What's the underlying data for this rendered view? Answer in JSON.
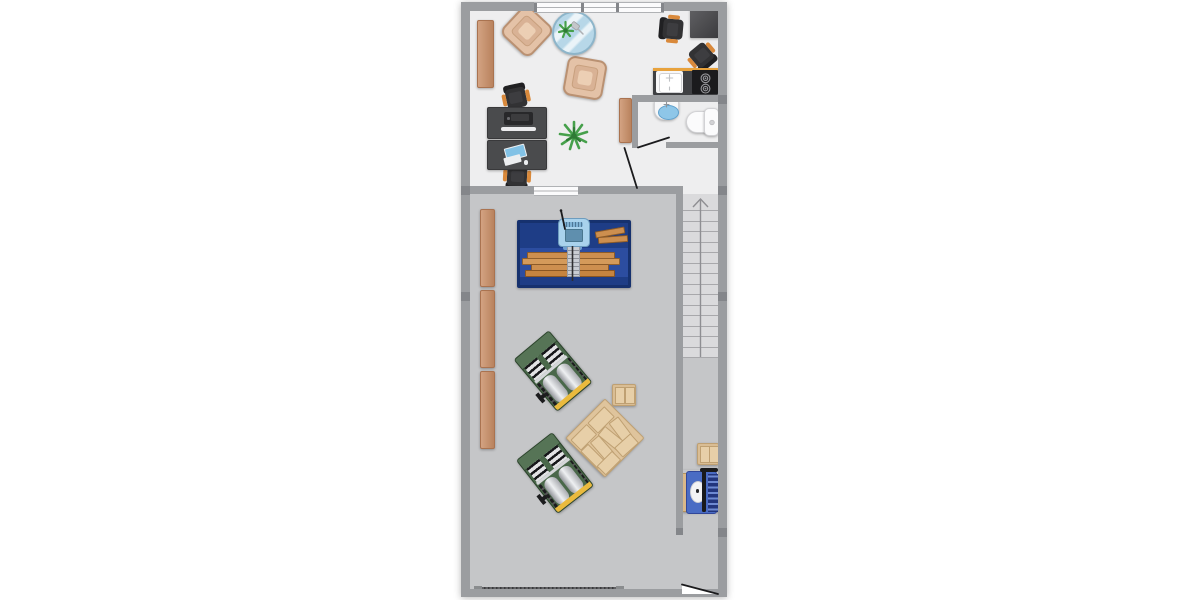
{
  "meta": {
    "view": "2d-floor-plan",
    "canvas": {
      "width": 1200,
      "height": 600
    }
  },
  "palette": {
    "page-bg": "#ffffff",
    "wall": "#9b9da0",
    "wall-joint": "#84868a",
    "office-floor": "#eeeeef",
    "workshop-floor": "#c5c6c8",
    "stair-floor": "#dadadc",
    "stair-line": "#a8a8ab",
    "window-fill": "#fbfbfc",
    "window-line": "#b0b2b5",
    "door-line": "#1b1b1d",
    "shelf": "#c98e66",
    "shelf-border": "#aa7350",
    "armchair": "#e4c2a7",
    "armchair-border": "#ba9172",
    "armchair-cushion": "#d9b295",
    "armchair-cushion-light": "#eccfb4",
    "glass": "#b7d7e8",
    "glass-border": "#8db5ca",
    "plant": "#46a04b",
    "plant-dark": "#2f7a35",
    "chair-body": "#323234",
    "chair-dark": "#202022",
    "chair-accent": "#d9893b",
    "desk": "#4a4b4d",
    "desk-border": "#39393b",
    "printer": "#28282a",
    "paper": "#ececee",
    "screen": "#82c2e6",
    "counter": "#3f4043",
    "counter-edge": "#e8a23c",
    "cooktop": "#1b1b1d",
    "fixture-white": "#f7f7f8",
    "fixture-border": "#d2d2d5",
    "basin-blue": "#8ec6e8",
    "bench": "#1e3d86",
    "bench-mid": "#2c4da0",
    "bench-border": "#16316e",
    "machine-head": "#a9d2ec",
    "machine-screen": "#5f8fae",
    "column": "#c9cdd3",
    "wood": "#cd8f4f",
    "green-machine": "#4a684a",
    "green-machine-light": "#567456",
    "green-machine-border": "#2b432b",
    "stripe-light": "#e2e2e4",
    "stripe-dark": "#17171a",
    "yellow": "#eaba3e",
    "pallet": "#dfc49c",
    "pallet-border": "#bfa072",
    "pallet-plank": "#e7cfa8",
    "crate": "#d9bd94",
    "blue-machine": "#4a6cc4",
    "blue-machine-dark": "#22357c",
    "blue-machine-slat": "#6e8ad2",
    "machine-base-wood": "#d9b98a",
    "garage-bar": "#59595c"
  },
  "plan": {
    "rooms": [
      {
        "id": "office-studio",
        "floor": "office-floor"
      },
      {
        "id": "kitchenette",
        "floor": "office-floor"
      },
      {
        "id": "bathroom",
        "floor": "office-floor"
      },
      {
        "id": "hallway",
        "floor": "office-floor"
      },
      {
        "id": "workshop",
        "floor": "workshop-floor"
      },
      {
        "id": "stairwell",
        "floor": "stair-floor"
      }
    ],
    "stairs": {
      "steps": 14,
      "direction": "up"
    },
    "openings": {
      "windows": 2,
      "doors": 3,
      "garage_doors": 1
    },
    "items": [
      {
        "name": "sideboard",
        "room": "office-studio",
        "count": 2
      },
      {
        "name": "armchair",
        "room": "office-studio",
        "count": 2
      },
      {
        "name": "round-glass-table",
        "room": "office-studio",
        "count": 1
      },
      {
        "name": "table-plant",
        "room": "office-studio",
        "count": 1
      },
      {
        "name": "floor-plant",
        "room": "office-studio",
        "count": 1
      },
      {
        "name": "office-chair",
        "room": "office-studio",
        "count": 4
      },
      {
        "name": "desk-with-printer",
        "room": "office-studio",
        "count": 1
      },
      {
        "name": "desk-with-computer",
        "room": "office-studio",
        "count": 1
      },
      {
        "name": "corner-table",
        "room": "office-studio",
        "count": 1
      },
      {
        "name": "kitchen-counter-sink-cooktop",
        "room": "kitchenette",
        "count": 1
      },
      {
        "name": "wash-basin",
        "room": "bathroom",
        "count": 1
      },
      {
        "name": "toilet",
        "room": "bathroom",
        "count": 1
      },
      {
        "name": "workbench-with-saw",
        "room": "workshop",
        "count": 1
      },
      {
        "name": "lumber-planks",
        "room": "workshop",
        "count": 6
      },
      {
        "name": "planer-machine",
        "room": "workshop",
        "count": 2
      },
      {
        "name": "wood-pallet",
        "room": "workshop",
        "count": 1
      },
      {
        "name": "wood-crate",
        "room": "workshop",
        "count": 2
      },
      {
        "name": "dust-collector",
        "room": "workshop",
        "count": 1
      },
      {
        "name": "wall-shelf",
        "room": "workshop",
        "count": 3
      },
      {
        "name": "staircase",
        "room": "stairwell",
        "count": 1
      }
    ]
  }
}
